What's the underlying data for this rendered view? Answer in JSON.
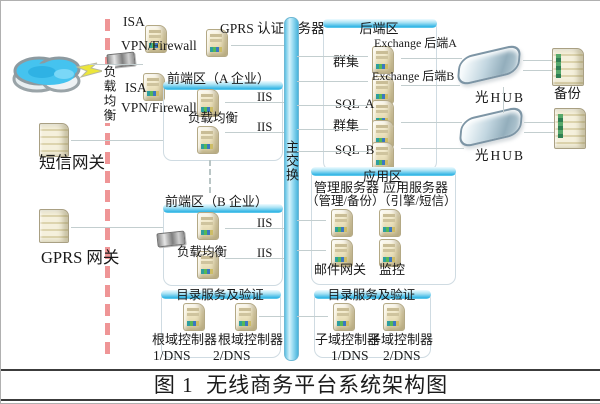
{
  "colors": {
    "accent_cyan": "#33b5e5",
    "boundary_red": "#ef9596",
    "line_gray": "#c3cecf",
    "server_beige": "#eee4c0",
    "cloud_blue": "#45c3ef"
  },
  "labels": {
    "load_balance_vertical": "负载均衡",
    "isa": "ISA",
    "vpn_firewall": "VPN/Firewall",
    "sms_gateway": "短信网关",
    "gprs_gateway": "GPRS 网关",
    "gprs_auth_server": "GPRS 认证服务器",
    "main_switch": "主交换",
    "zone_a_title": "前端区（A 企业）",
    "zone_b_title": "前端区（B 企业）",
    "load_balance": "负载均衡",
    "iis": "IIS",
    "backend_title": "后端区",
    "exchange_a": "Exchange 后端A",
    "exchange_b": "Exchange 后端B",
    "cluster": "群集",
    "sql_a": "SQL  A",
    "sql_b": "SQL  B",
    "optical_hub": "光HUB",
    "backup": "备份",
    "app_zone_title": "应用区",
    "mgmt_server": "管理服务器",
    "mgmt_server_sub": "（管理/备份）",
    "app_server": "应用服务器",
    "app_server_sub": "（引擎/短信）",
    "mail_gateway": "邮件网关",
    "monitor": "监控",
    "dir_title": "目录服务及验证",
    "root_dc": "根域控制器",
    "sub_dc": "子域控制器",
    "dns1": "1/DNS",
    "dns2": "2/DNS",
    "caption": "图 1  无线商务平台系统架构图"
  }
}
